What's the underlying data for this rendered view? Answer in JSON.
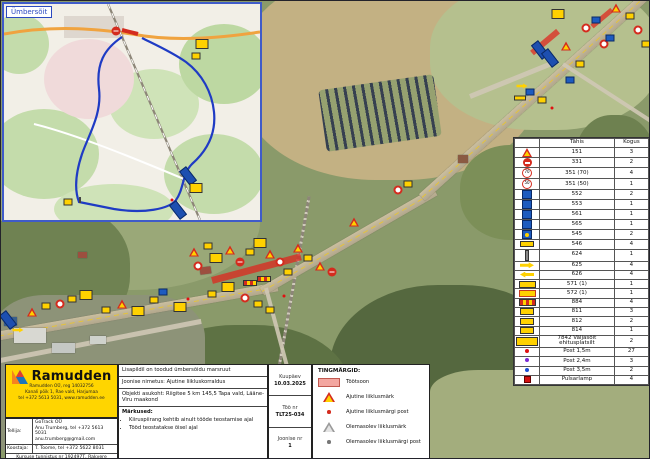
{
  "inset": {
    "label": "Ümbersõit"
  },
  "sign_table": {
    "code_header": "Tähis",
    "qty_header": "Kogus",
    "rows": [
      {
        "icon": "tri",
        "code": "151",
        "qty": "3"
      },
      {
        "icon": "noentry",
        "code": "331",
        "qty": "2"
      },
      {
        "icon": "s70",
        "code": "351 (70)",
        "qty": "4"
      },
      {
        "icon": "s50",
        "code": "351 (50)",
        "qty": "1"
      },
      {
        "icon": "blue",
        "code": "552",
        "qty": "2"
      },
      {
        "icon": "blue",
        "code": "553",
        "qty": "1"
      },
      {
        "icon": "blue",
        "code": "561",
        "qty": "1"
      },
      {
        "icon": "blue",
        "code": "565",
        "qty": "1"
      },
      {
        "icon": "yb",
        "code": "545",
        "qty": "2"
      },
      {
        "icon": "ybar",
        "code": "546",
        "qty": "4"
      },
      {
        "icon": "post",
        "code": "624",
        "qty": "1"
      },
      {
        "icon": "arr-r",
        "code": "625",
        "qty": "4"
      },
      {
        "icon": "arr-l",
        "code": "626",
        "qty": "4"
      },
      {
        "icon": "yplate",
        "code": "571 (1)",
        "qty": "1"
      },
      {
        "icon": "yplate2",
        "code": "572 (1)",
        "qty": "1"
      },
      {
        "icon": "stripe",
        "code": "884",
        "qty": "4"
      },
      {
        "icon": "ysm",
        "code": "811",
        "qty": "3"
      },
      {
        "icon": "ysm",
        "code": "812",
        "qty": "2"
      },
      {
        "icon": "ysm",
        "code": "814",
        "qty": "1"
      },
      {
        "icon": "ywide",
        "code": "7842 Väljasõit ehitusplatsilt",
        "qty": "2"
      },
      {
        "icon": "dot-red",
        "code": "Post 1,5m",
        "qty": "27"
      },
      {
        "icon": "dot-purple",
        "code": "Post 2,4m",
        "qty": "3"
      },
      {
        "icon": "dot-blue",
        "code": "Post 3,5m",
        "qty": "2"
      },
      {
        "icon": "sq-red",
        "code": "Pulsarlamp",
        "qty": "4"
      }
    ]
  },
  "legend": {
    "title": "TINGMÄRGID:",
    "items": [
      {
        "icon": "workzone",
        "label": "Töötsoon"
      },
      {
        "icon": "temp-sign",
        "label": "Ajutine liiklusmärk"
      },
      {
        "icon": "temp-post",
        "label": "Ajutine liiklusmärgi post"
      },
      {
        "icon": "existing-sign",
        "label": "Olemasolev liiklusmärk"
      },
      {
        "icon": "existing-post",
        "label": "Olemasolev liiklusmärgi post"
      }
    ]
  },
  "titleblock": {
    "note_top": "Lisapildil on toodud ümbersõidu marsruut",
    "drawing_label": "Joonise nimetus:",
    "drawing_name": "Ajutine liikluskorraldus",
    "location_label": "Objekti asukoht:",
    "location": "Riigitee 5 km 145,5 Tapa vald, Lääne-Viru maakond",
    "notes_title": "Märkused:",
    "note1": "Kiiruspiirang kehtib ainult tööde teostamise ajal",
    "note2": "Tööd teostatakse öisel ajal",
    "date_label": "Kuupäev",
    "date_value": "10.03.2025",
    "work_label": "Töö nr",
    "work_value": "TLT25-034",
    "sheet_label": "Joonise nr",
    "sheet_value": "1"
  },
  "company": {
    "logo_text": "Ramudden",
    "logo_sub1": "Ramudden OÜ, reg 14032756",
    "logo_sub2": "Kanali põik 1, Rae vald, Harjumaa",
    "logo_sub3": "tel +372 5613 5031, www.ramudden.ee",
    "client_label": "Tellija:",
    "client_line1": "GoTrack OÜ",
    "client_line2": "Anu Trumberg, tel +372 5613 5031",
    "client_line3": "anu.trumberg@gmail.com",
    "author_label": "Koostaja:",
    "author_value": "T. Toome, tel +372 5622 8031",
    "cert": "Kursuse tunnistus nr 192497T, Rakvere",
    "license": "Tegevusluba nr EL1000623"
  },
  "map": {
    "colors": {
      "workzone": "#e0231c",
      "detour_route": "#1f3bc4",
      "ramudden_yellow": "#ffd500"
    },
    "markers": [
      [
        "bboard",
        8,
        320
      ],
      [
        "arr",
        18,
        330
      ],
      [
        "tri",
        32,
        312
      ],
      [
        "yrect",
        46,
        306
      ],
      [
        "circ",
        60,
        304
      ],
      [
        "yrect",
        72,
        299
      ],
      [
        "ybig",
        86,
        295
      ],
      [
        "yrect",
        106,
        310
      ],
      [
        "tri",
        122,
        304
      ],
      [
        "ybig",
        138,
        311
      ],
      [
        "yrect",
        154,
        300
      ],
      [
        "brect",
        163,
        292
      ],
      [
        "ybig",
        180,
        307
      ],
      [
        "dotr",
        188,
        299
      ],
      [
        "tri",
        194,
        252
      ],
      [
        "circ",
        198,
        266
      ],
      [
        "yrect",
        208,
        246
      ],
      [
        "ybig",
        216,
        258
      ],
      [
        "tri",
        230,
        250
      ],
      [
        "noentry",
        240,
        262
      ],
      [
        "yrect",
        250,
        252
      ],
      [
        "ybig",
        260,
        243
      ],
      [
        "tri",
        270,
        254
      ],
      [
        "circ",
        280,
        262
      ],
      [
        "yrect",
        288,
        272
      ],
      [
        "tri",
        298,
        248
      ],
      [
        "yrect",
        308,
        258
      ],
      [
        "tri",
        320,
        266
      ],
      [
        "noentry",
        332,
        272
      ],
      [
        "ybig",
        228,
        287
      ],
      [
        "yrect",
        212,
        294
      ],
      [
        "circ",
        245,
        298
      ],
      [
        "yrect",
        258,
        304
      ],
      [
        "yrect",
        270,
        310
      ],
      [
        "dotr",
        284,
        296
      ],
      [
        "barrier",
        250,
        283
      ],
      [
        "barrier",
        264,
        279
      ],
      [
        "tri",
        354,
        222
      ],
      [
        "circ",
        398,
        190
      ],
      [
        "yrect",
        408,
        184
      ],
      [
        "bboard",
        540,
        50
      ],
      [
        "bboard",
        550,
        58
      ],
      [
        "tri",
        566,
        46
      ],
      [
        "yrect",
        580,
        64
      ],
      [
        "circ",
        586,
        28
      ],
      [
        "brect",
        596,
        20
      ],
      [
        "circ",
        604,
        44
      ],
      [
        "brect",
        610,
        38
      ],
      [
        "arr",
        522,
        86
      ],
      [
        "brect",
        530,
        92
      ],
      [
        "ybar",
        520,
        98
      ],
      [
        "yrect",
        542,
        100
      ],
      [
        "dotr",
        552,
        108
      ],
      [
        "brect",
        570,
        80
      ],
      [
        "ybig",
        558,
        14
      ],
      [
        "tri",
        616,
        8
      ],
      [
        "yrect",
        630,
        16
      ],
      [
        "circ",
        638,
        30
      ],
      [
        "yrect",
        646,
        44
      ]
    ],
    "inset_markers": [
      [
        "ybig",
        198,
        40
      ],
      [
        "yrect",
        192,
        52
      ],
      [
        "bboard",
        184,
        172
      ],
      [
        "ybig",
        192,
        184
      ],
      [
        "dotr",
        168,
        196
      ],
      [
        "bboard",
        174,
        206
      ],
      [
        "yrect",
        64,
        198
      ],
      [
        "post",
        76,
        196
      ],
      [
        "noentry",
        112,
        27
      ]
    ]
  }
}
